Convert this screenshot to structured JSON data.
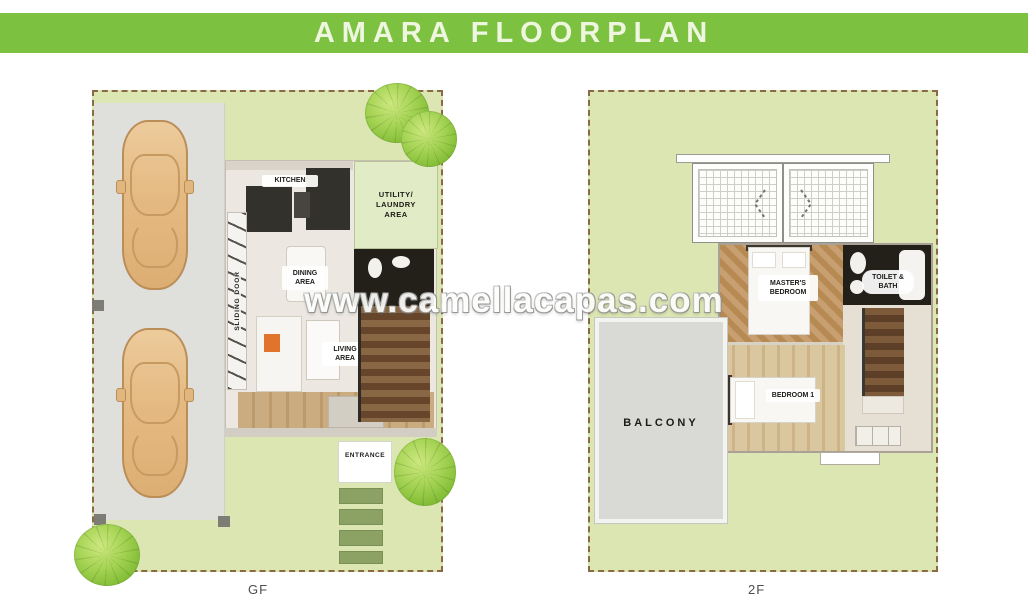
{
  "banner": {
    "title": "AMARA FLOORPLAN"
  },
  "watermark": {
    "text": "www.camellacapas.com"
  },
  "colors": {
    "banner_green": "#7DC141",
    "lawn_green": "#DCE6B2",
    "utility_green": "#E1EBC6",
    "driveway_gray": "#DFDFDC",
    "balcony_gray": "#D9DAD6",
    "stone_green": "#8CA264",
    "lot_border_brown": "#8A6A45",
    "car_tan": "#E5BA82",
    "accent_orange": "#E0742C"
  },
  "gf": {
    "caption": "GF",
    "labels": {
      "kitchen": "KITCHEN",
      "sliding_door": "SLIDING DOOR",
      "utility": "UTILITY/\nLAUNDRY\nAREA",
      "dining": "DINING\nAREA",
      "living": "LIVING\nAREA",
      "entrance": "ENTRANCE"
    }
  },
  "sf": {
    "caption": "2F",
    "labels": {
      "balcony": "BALCONY",
      "master": "MASTER'S\nBEDROOM",
      "toilet": "TOILET &\nBATH",
      "bedroom1": "BEDROOM 1"
    }
  }
}
